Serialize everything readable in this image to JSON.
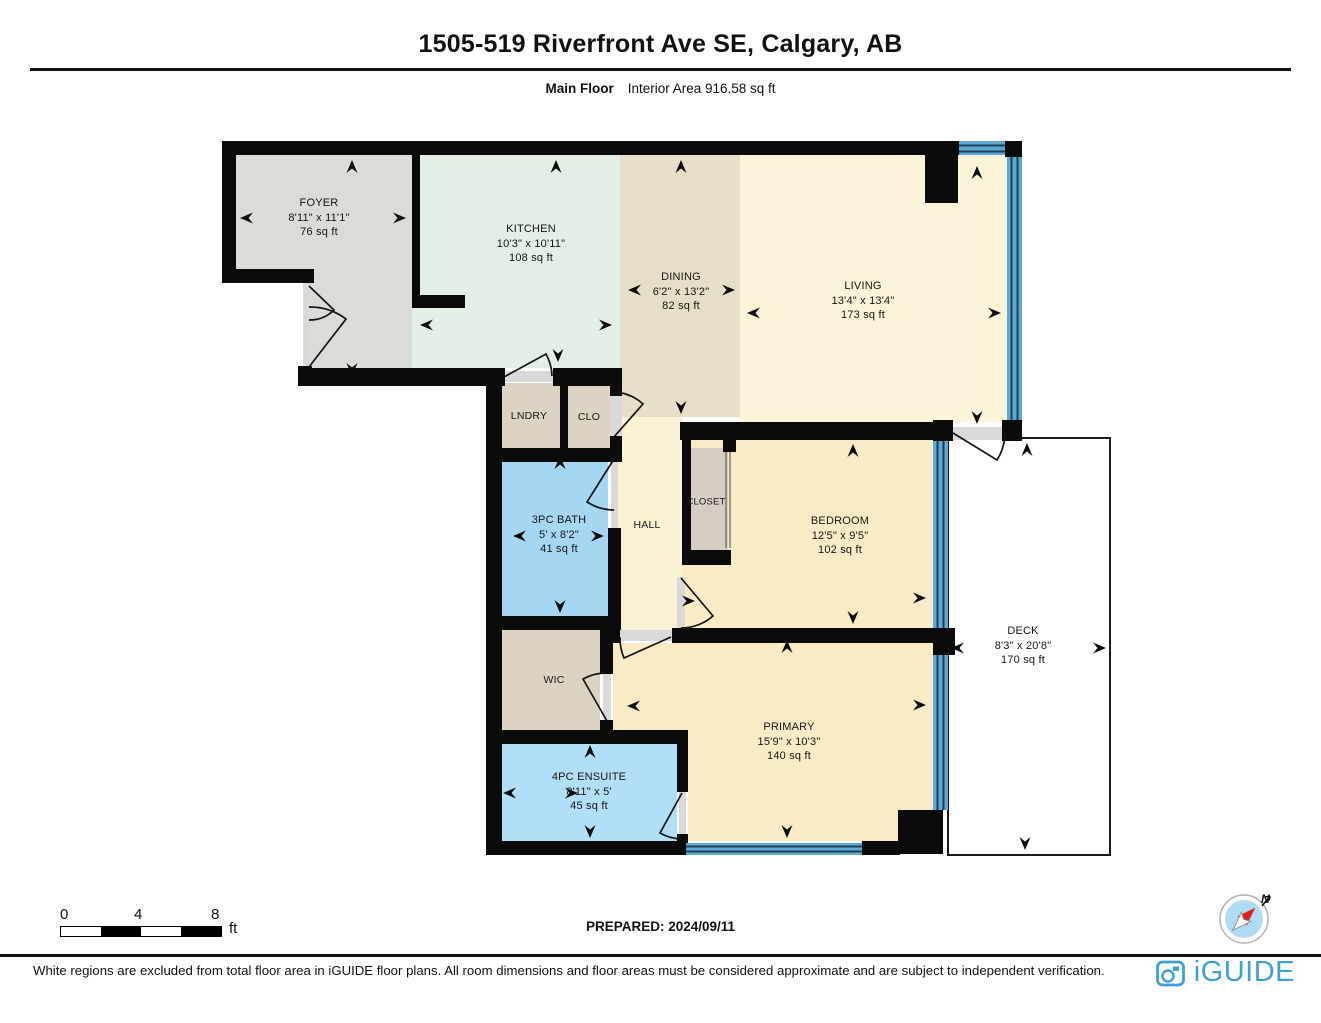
{
  "header": {
    "title": "1505-519 Riverfront Ave SE, Calgary, AB",
    "floor_label": "Main Floor",
    "area_label": "Interior Area 916.58 sq ft"
  },
  "rooms": [
    {
      "name": "FOYER",
      "dims": "8'11\" x 11'1\"",
      "area": "76 sq ft"
    },
    {
      "name": "KITCHEN",
      "dims": "10'3\" x 10'11\"",
      "area": "108 sq ft"
    },
    {
      "name": "DINING",
      "dims": "6'2\" x 13'2\"",
      "area": "82 sq ft"
    },
    {
      "name": "LIVING",
      "dims": "13'4\" x 13'4\"",
      "area": "173 sq ft"
    },
    {
      "name": "LNDRY"
    },
    {
      "name": "CLO"
    },
    {
      "name": "3PC BATH",
      "dims": "5' x 8'2\"",
      "area": "41 sq ft"
    },
    {
      "name": "HALL"
    },
    {
      "name": "CLOSET"
    },
    {
      "name": "BEDROOM",
      "dims": "12'5\" x 9'5\"",
      "area": "102 sq ft"
    },
    {
      "name": "DECK",
      "dims": "8'3\" x 20'8\"",
      "area": "170 sq ft"
    },
    {
      "name": "WIC"
    },
    {
      "name": "PRIMARY",
      "dims": "15'9\" x 10'3\"",
      "area": "140 sq ft"
    },
    {
      "name": "4PC ENSUITE",
      "dims": "8'11\" x 5'",
      "area": "45 sq ft"
    }
  ],
  "scale_bar": {
    "tick0": "0",
    "tick4": "4",
    "tick8": "8",
    "unit": "ft"
  },
  "compass": {
    "north_label": "N"
  },
  "footer": {
    "prepared": "PREPARED: 2024/09/11",
    "disclaimer": "White regions are excluded from total floor area in iGUIDE floor plans. All room dimensions and floor areas must be considered approximate and are subject to independent verification.",
    "brand": "iGUIDE"
  },
  "colors": {
    "wall": "#0b0b0b",
    "window_blue": "#5ea8d2",
    "window_line": "#1d3f5a",
    "foyer": "#dbdbd8",
    "kitchen": "#e3efe4",
    "dining": "#e6dec6",
    "living": "#fbf4d9",
    "hall": "#fbf2d6",
    "bedroom": "#f8ebc5",
    "bath": "#a6d7f2",
    "ensuite": "#b1dff7",
    "closet_tan": "#ddd3c2",
    "threshold": "#d9d9d9",
    "brand_blue": "#3f9fd9",
    "compass_fill": "#aedcf4"
  }
}
